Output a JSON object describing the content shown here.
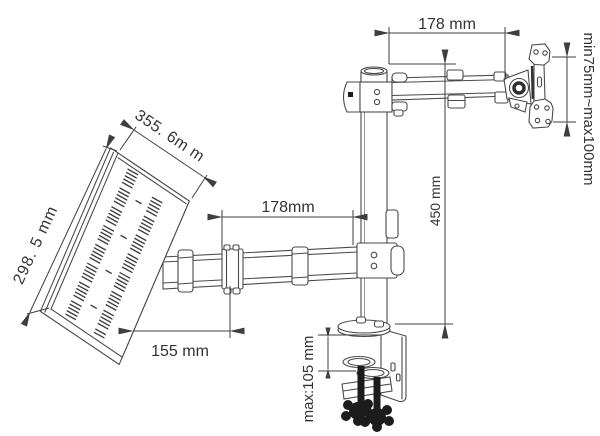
{
  "diagram": {
    "type": "technical-line-drawing",
    "subject": "desk clamp monitor arm with laptop tray",
    "background_color": "#ffffff",
    "line_color": "#4a4a4a",
    "dimension_color": "#3e3e3e",
    "text_color": "#333333",
    "labels": {
      "upper_arm_length": "178 mm",
      "vesa_height_range": "min75mm~max100mm",
      "tray_width": "355. 6m m",
      "tray_depth": "298. 5 mm",
      "lower_arm_length": "178mm",
      "pole_height": "450 mm",
      "tray_offset": "155 mm",
      "clamp_thickness": "max:105 mm"
    }
  }
}
